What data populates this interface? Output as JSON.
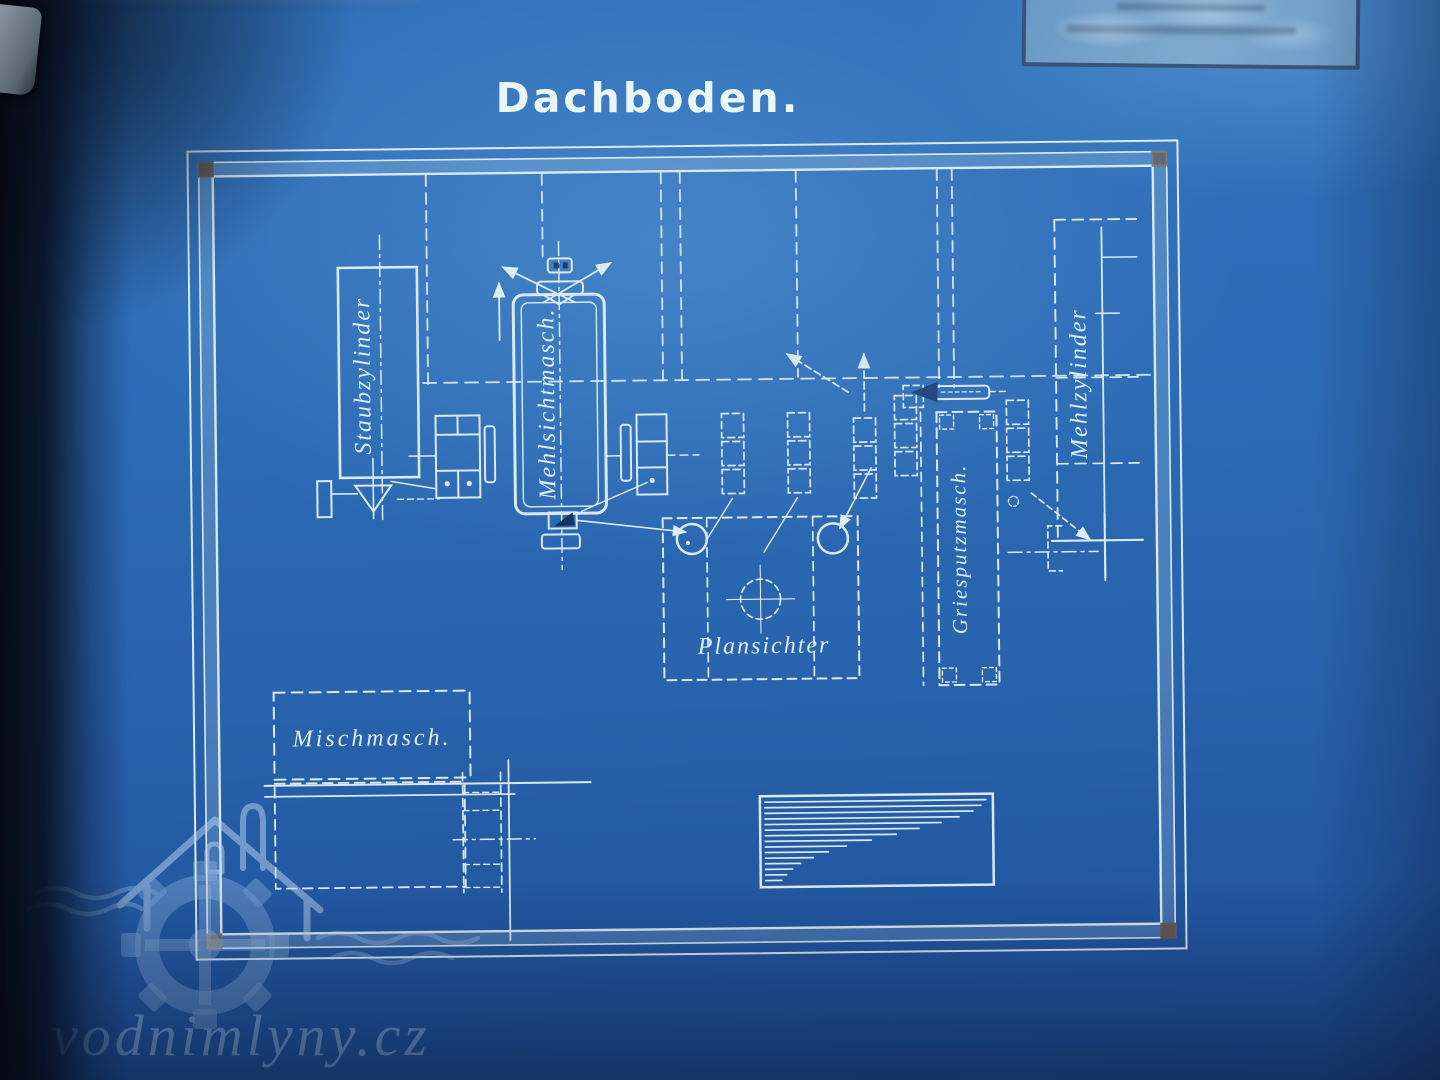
{
  "title": "Dachboden.",
  "machines": {
    "staubzylinder": {
      "label": "Staubzylinder"
    },
    "mehlsichtmasch": {
      "label": "Mehlsichtmasch."
    },
    "plansichter": {
      "label": "Plansichter"
    },
    "griesputzmasch": {
      "label": "Griesputzmasch."
    },
    "mehlzylinder": {
      "label": "Mehlzylinder"
    },
    "mischmasch": {
      "label": "Mischmasch."
    }
  },
  "watermark": {
    "text": "vodnimlyny.cz"
  },
  "colors": {
    "paper_blue": "#2b68b2",
    "line_cream": "#d9eaee",
    "frame_corner_mark": "#63564c",
    "stamp_border": "#263a5c",
    "watermark_blue": "#b4d1ee"
  }
}
